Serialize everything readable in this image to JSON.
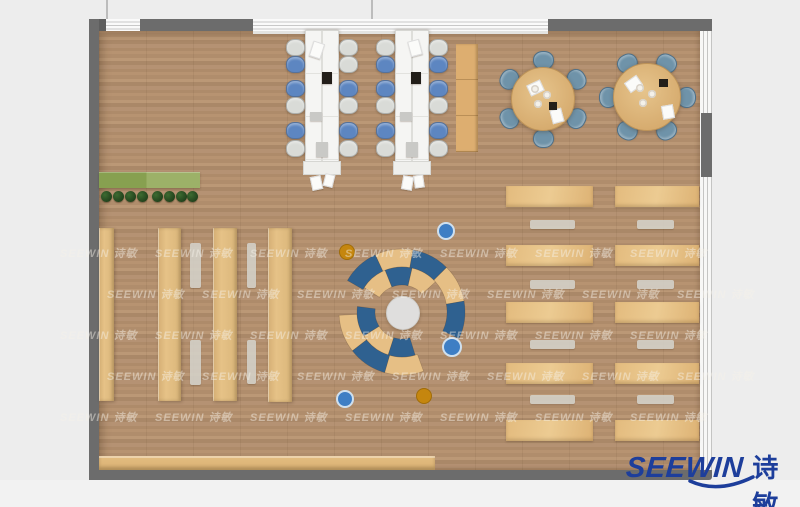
{
  "canvas": {
    "w": 800,
    "h": 507,
    "bg": "#ededed",
    "bg_bottom": "#f2f2f2"
  },
  "palette": {
    "wall": "#6c6c6c",
    "wall_dark": "#5e5e5e",
    "window_line": "#c8c8c8",
    "floor_base": "#b18e6d",
    "wood": "#e2ba7e",
    "table_white": "#f5f5f3",
    "chair_blue": "#5d86c1",
    "chair_gray": "#d9dbd7",
    "chair_steel": "#6f93a9",
    "sofa_blue": "#2f6190",
    "sofa_tan": "#e6bf85",
    "sofa_center": "#dfdedd",
    "ottoman_blue": "#3e7ec4",
    "ottoman_blue_ring": "#cfe0ef",
    "ottoman_amber": "#c5860e",
    "ottoman_amber_edge": "#a06c08",
    "bench_gray": "#d2cfc7",
    "planter_dark": "#87a050",
    "planter_light": "#9cb168",
    "plant_green": "#2d5226",
    "logo_blue": "#1d3e9b",
    "watermark_color": "rgba(246,242,233,0.46)",
    "item_paper": "#fbfbf9",
    "item_dark": "#221e19",
    "item_gray": "#c9c9c6"
  },
  "brand": {
    "en": "SEEWIN",
    "cn": "诗敏",
    "swoosh_d": "M690,481 Q718,494 753,477"
  },
  "watermark": {
    "text": "SEEWIN 诗敏",
    "x0": 95,
    "step": 95,
    "count": 7,
    "rows": [
      {
        "y": 245,
        "offset": -35
      },
      {
        "y": 286,
        "offset": 12
      },
      {
        "y": 327,
        "offset": -35
      },
      {
        "y": 368,
        "offset": 12
      },
      {
        "y": 409,
        "offset": -35
      }
    ]
  },
  "walls": {
    "floor": {
      "x": 99,
      "y": 30,
      "w": 601,
      "h": 440
    },
    "top_band": {
      "x": 90,
      "y": 19,
      "w": 622,
      "h": 12
    },
    "top_dark_segments": [
      {
        "x": 90,
        "w": 16
      },
      {
        "x": 140,
        "w": 113
      },
      {
        "x": 548,
        "w": 164
      }
    ],
    "window_sill": {
      "x": 253,
      "y": 30,
      "w": 295,
      "h": 4
    },
    "left_wall": {
      "x": 89,
      "y": 19,
      "w": 10,
      "h": 461
    },
    "bottom_wall": {
      "x": 89,
      "y": 470,
      "w": 623,
      "h": 10
    },
    "right_band": {
      "x": 700,
      "y": 31,
      "w": 12,
      "h": 439
    },
    "right_dark": {
      "x": 701,
      "y": 113,
      "w": 11,
      "h": 64
    },
    "exterior_lines": [
      {
        "x": 106,
        "y": 0,
        "h": 19
      },
      {
        "x": 371,
        "y": 0,
        "h": 19
      }
    ]
  },
  "furniture": {
    "planter": {
      "x": 99,
      "y": 172,
      "w": 101,
      "h": 16
    },
    "plants": {
      "cy": 196,
      "r": 5.5,
      "xs": [
        106.5,
        118.5,
        130.5,
        142.5,
        157,
        169,
        181,
        192.5
      ]
    },
    "shelf_columns": [
      {
        "x": 99,
        "y": 228,
        "w": 15,
        "h": 173
      },
      {
        "x": 158,
        "y": 228,
        "w": 23,
        "h": 173
      },
      {
        "x": 213,
        "y": 228,
        "w": 24,
        "h": 173
      },
      {
        "x": 268,
        "y": 228,
        "w": 24,
        "h": 174
      }
    ],
    "bench_strips": [
      {
        "x": 190,
        "y": 243,
        "w": 11,
        "h": 45
      },
      {
        "x": 190,
        "y": 340,
        "w": 11,
        "h": 45
      },
      {
        "x": 247,
        "y": 243,
        "w": 9,
        "h": 45
      },
      {
        "x": 247,
        "y": 340,
        "w": 9,
        "h": 44
      }
    ],
    "wall_cabinet": {
      "x": 456,
      "y": 44,
      "w": 22,
      "h": 108
    },
    "counter": {
      "x": 99,
      "y": 456,
      "w": 336,
      "h": 14
    },
    "long_tables": [
      {
        "x": 305,
        "y": 30,
        "w": 32,
        "h": 131,
        "endcap_h": 12,
        "chairs_left": [
          "gray",
          "blue",
          "blue",
          "gray",
          "blue",
          "gray"
        ],
        "chairs_right": [
          "gray",
          "gray",
          "blue",
          "gray",
          "blue",
          "gray"
        ],
        "items": [
          {
            "dx": 6,
            "dy": 12,
            "w": 10,
            "h": 14,
            "rot": 18,
            "t": "paper"
          },
          {
            "dx": 17,
            "dy": 42,
            "w": 10,
            "h": 12,
            "rot": 0,
            "t": "dark"
          },
          {
            "dx": 5,
            "dy": 82,
            "w": 12,
            "h": 9,
            "rot": 0,
            "t": "gray"
          },
          {
            "dx": 11,
            "dy": 112,
            "w": 12,
            "h": 15,
            "rot": 0,
            "t": "gray"
          },
          {
            "dx": 6,
            "dy": 146,
            "w": 9,
            "h": 12,
            "rot": -12,
            "t": "paper"
          },
          {
            "dx": 19,
            "dy": 144,
            "w": 8,
            "h": 11,
            "rot": 14,
            "t": "paper"
          }
        ]
      },
      {
        "x": 395,
        "y": 30,
        "w": 32,
        "h": 131,
        "endcap_h": 12,
        "chairs_left": [
          "gray",
          "blue",
          "blue",
          "gray",
          "blue",
          "gray"
        ],
        "chairs_right": [
          "gray",
          "blue",
          "blue",
          "gray",
          "blue",
          "gray"
        ],
        "items": [
          {
            "dx": 14,
            "dy": 10,
            "w": 10,
            "h": 14,
            "rot": -15,
            "t": "paper"
          },
          {
            "dx": 16,
            "dy": 42,
            "w": 10,
            "h": 12,
            "rot": 0,
            "t": "dark"
          },
          {
            "dx": 5,
            "dy": 82,
            "w": 12,
            "h": 9,
            "rot": 0,
            "t": "gray"
          },
          {
            "dx": 11,
            "dy": 112,
            "w": 12,
            "h": 15,
            "rot": 0,
            "t": "gray"
          },
          {
            "dx": 7,
            "dy": 146,
            "w": 9,
            "h": 12,
            "rot": 10,
            "t": "paper"
          },
          {
            "dx": 19,
            "dy": 145,
            "w": 8,
            "h": 11,
            "rot": -8,
            "t": "paper"
          }
        ]
      }
    ],
    "long_table_chair_rows_y": [
      39,
      56,
      80,
      97,
      122,
      140
    ],
    "long_table_chair_size": {
      "w": 17,
      "h": 15
    },
    "round_tables": [
      {
        "cx": 542,
        "cy": 98,
        "r": 31,
        "chair_angles": [
          0,
          60,
          120,
          180,
          240,
          300
        ],
        "items": [
          {
            "dx": -14,
            "dy": -16,
            "w": 13,
            "h": 10,
            "rot": -25,
            "t": "paper"
          },
          {
            "dx": 8,
            "dy": 12,
            "w": 12,
            "h": 10,
            "rot": 75,
            "t": "paper"
          },
          {
            "dx": 7,
            "dy": 4,
            "w": 8,
            "h": 8,
            "rot": 0,
            "t": "dark"
          }
        ],
        "plates": [
          {
            "dx": -7,
            "dy": -9
          },
          {
            "dx": 5,
            "dy": -3
          },
          {
            "dx": -4,
            "dy": 6
          }
        ]
      },
      {
        "cx": 646,
        "cy": 96,
        "r": 33,
        "chair_angles": [
          30,
          90,
          150,
          210,
          270,
          330
        ],
        "items": [
          {
            "dx": -20,
            "dy": -18,
            "w": 13,
            "h": 10,
            "rot": -35,
            "t": "paper"
          },
          {
            "dx": 15,
            "dy": 10,
            "w": 12,
            "h": 10,
            "rot": 80,
            "t": "paper"
          },
          {
            "dx": 13,
            "dy": -17,
            "w": 9,
            "h": 8,
            "rot": 0,
            "t": "dark"
          }
        ],
        "plates": [
          {
            "dx": -6,
            "dy": -8
          },
          {
            "dx": 6,
            "dy": -2
          },
          {
            "dx": -3,
            "dy": 7
          }
        ]
      }
    ],
    "round_chair_size": {
      "w": 19,
      "h": 17,
      "dist": 39
    },
    "desk_rows": {
      "cols": [
        {
          "x": 506,
          "w": 87
        },
        {
          "x": 615,
          "w": 84
        }
      ],
      "ys": [
        186,
        245,
        302,
        363,
        420
      ],
      "h": 21
    },
    "bench_rows": {
      "cols": [
        {
          "x": 530,
          "w": 45
        },
        {
          "x": 637,
          "w": 37
        }
      ],
      "ys": [
        220,
        280,
        340,
        395
      ],
      "h": 9
    },
    "sofa": {
      "cx": 402,
      "cy": 312,
      "center_r": 16,
      "outer_r": [
        45,
        63
      ],
      "inner_r": [
        27,
        45
      ],
      "segments": [
        {
          "band": "outer",
          "a0": 300,
          "a1": 335,
          "c": "blue"
        },
        {
          "band": "outer",
          "a0": 335,
          "a1": 370,
          "c": "tan"
        },
        {
          "band": "outer",
          "a0": 370,
          "a1": 405,
          "c": "blue"
        },
        {
          "band": "outer",
          "a0": 405,
          "a1": 440,
          "c": "tan"
        },
        {
          "band": "outer",
          "a0": 440,
          "a1": 475,
          "c": "blue"
        },
        {
          "band": "outer",
          "a0": 160,
          "a1": 196,
          "c": "tan"
        },
        {
          "band": "outer",
          "a0": 196,
          "a1": 232,
          "c": "blue"
        },
        {
          "band": "outer",
          "a0": 232,
          "a1": 267,
          "c": "tan"
        },
        {
          "band": "inner",
          "a0": 303,
          "a1": 338,
          "c": "tan"
        },
        {
          "band": "inner",
          "a0": 338,
          "a1": 373,
          "c": "blue"
        },
        {
          "band": "inner",
          "a0": 373,
          "a1": 408,
          "c": "tan"
        },
        {
          "band": "inner",
          "a0": 163,
          "a1": 198,
          "c": "blue"
        },
        {
          "band": "inner",
          "a0": 198,
          "a1": 238,
          "c": "tan"
        },
        {
          "band": "inner",
          "a0": 238,
          "a1": 277,
          "c": "blue"
        }
      ]
    },
    "dots": [
      {
        "cx": 444,
        "cy": 229,
        "r": 7,
        "type": "blue"
      },
      {
        "cx": 450,
        "cy": 345,
        "r": 8,
        "type": "blue"
      },
      {
        "cx": 343,
        "cy": 397,
        "r": 7,
        "type": "blue"
      },
      {
        "cx": 346,
        "cy": 251,
        "r": 7,
        "type": "amber"
      },
      {
        "cx": 423,
        "cy": 395,
        "r": 7,
        "type": "amber"
      }
    ]
  }
}
